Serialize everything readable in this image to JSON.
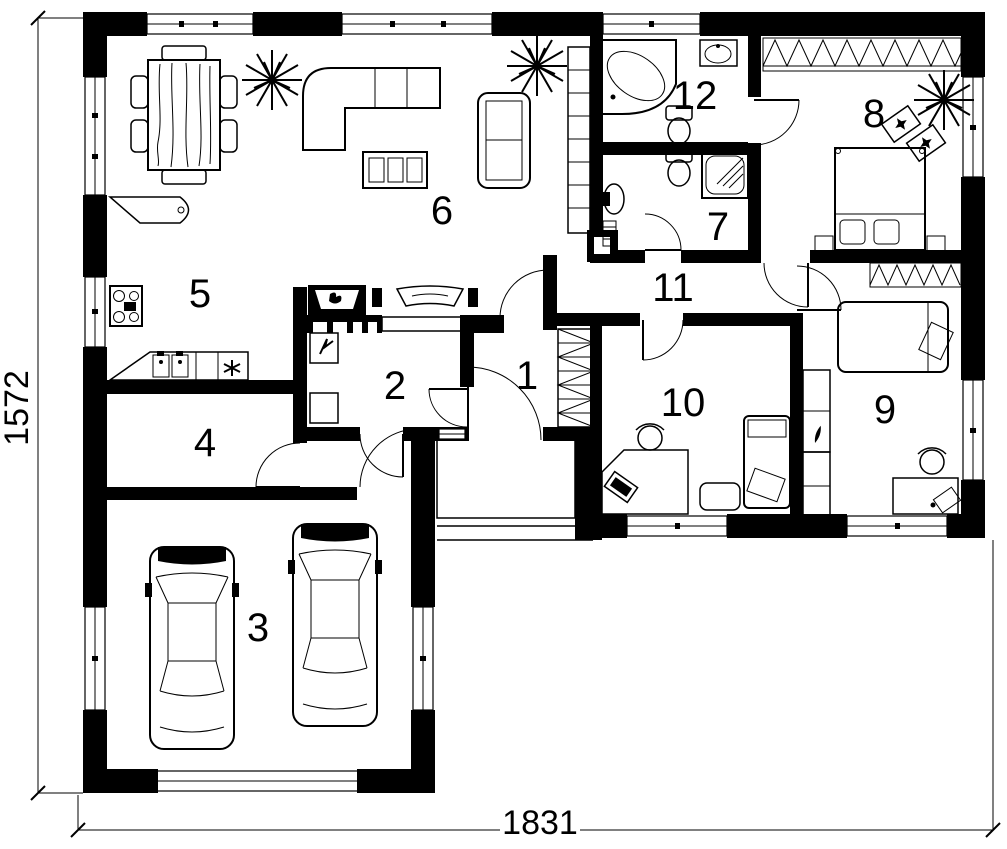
{
  "drawing": {
    "type": "house floor plan",
    "ink_color": "#000000",
    "paper_color": "#ffffff"
  },
  "dimensions": {
    "height_label": "1572",
    "width_label": "1831"
  },
  "rooms": [
    {
      "label": "1",
      "furniture": [
        "entrance-door",
        "porch-steps"
      ]
    },
    {
      "label": "2",
      "furniture": [
        "boiler",
        "cabinet",
        "wall-grille"
      ]
    },
    {
      "label": "3",
      "furniture": [
        "car",
        "car",
        "garage-door",
        "window",
        "window"
      ]
    },
    {
      "label": "4",
      "furniture": []
    },
    {
      "label": "5",
      "furniture": [
        "kitchen-peninsula",
        "stove",
        "counter",
        "double-sink",
        "dishwasher-mark"
      ]
    },
    {
      "label": "6",
      "furniture": [
        "dining-table",
        "six-chairs",
        "corner-sofa",
        "loveseat",
        "coffee-table",
        "shelf-unit",
        "fireplace",
        "tv",
        "plant",
        "plant"
      ]
    },
    {
      "label": "7",
      "furniture": [
        "shower",
        "washbasin",
        "toilet",
        "towel-radiator"
      ]
    },
    {
      "label": "8",
      "furniture": [
        "wardrobe",
        "double-bed",
        "nightstand",
        "nightstand",
        "armchair",
        "armchair",
        "plant"
      ]
    },
    {
      "label": "9",
      "furniture": [
        "wardrobe",
        "bed",
        "tall-cabinet",
        "desk",
        "office-chair",
        "laptop"
      ]
    },
    {
      "label": "10",
      "furniture": [
        "bed",
        "desk",
        "office-chair",
        "monitor",
        "bench"
      ]
    },
    {
      "label": "11",
      "furniture": []
    },
    {
      "label": "12",
      "furniture": [
        "corner-bathtub",
        "washbasin",
        "toilet"
      ]
    }
  ]
}
